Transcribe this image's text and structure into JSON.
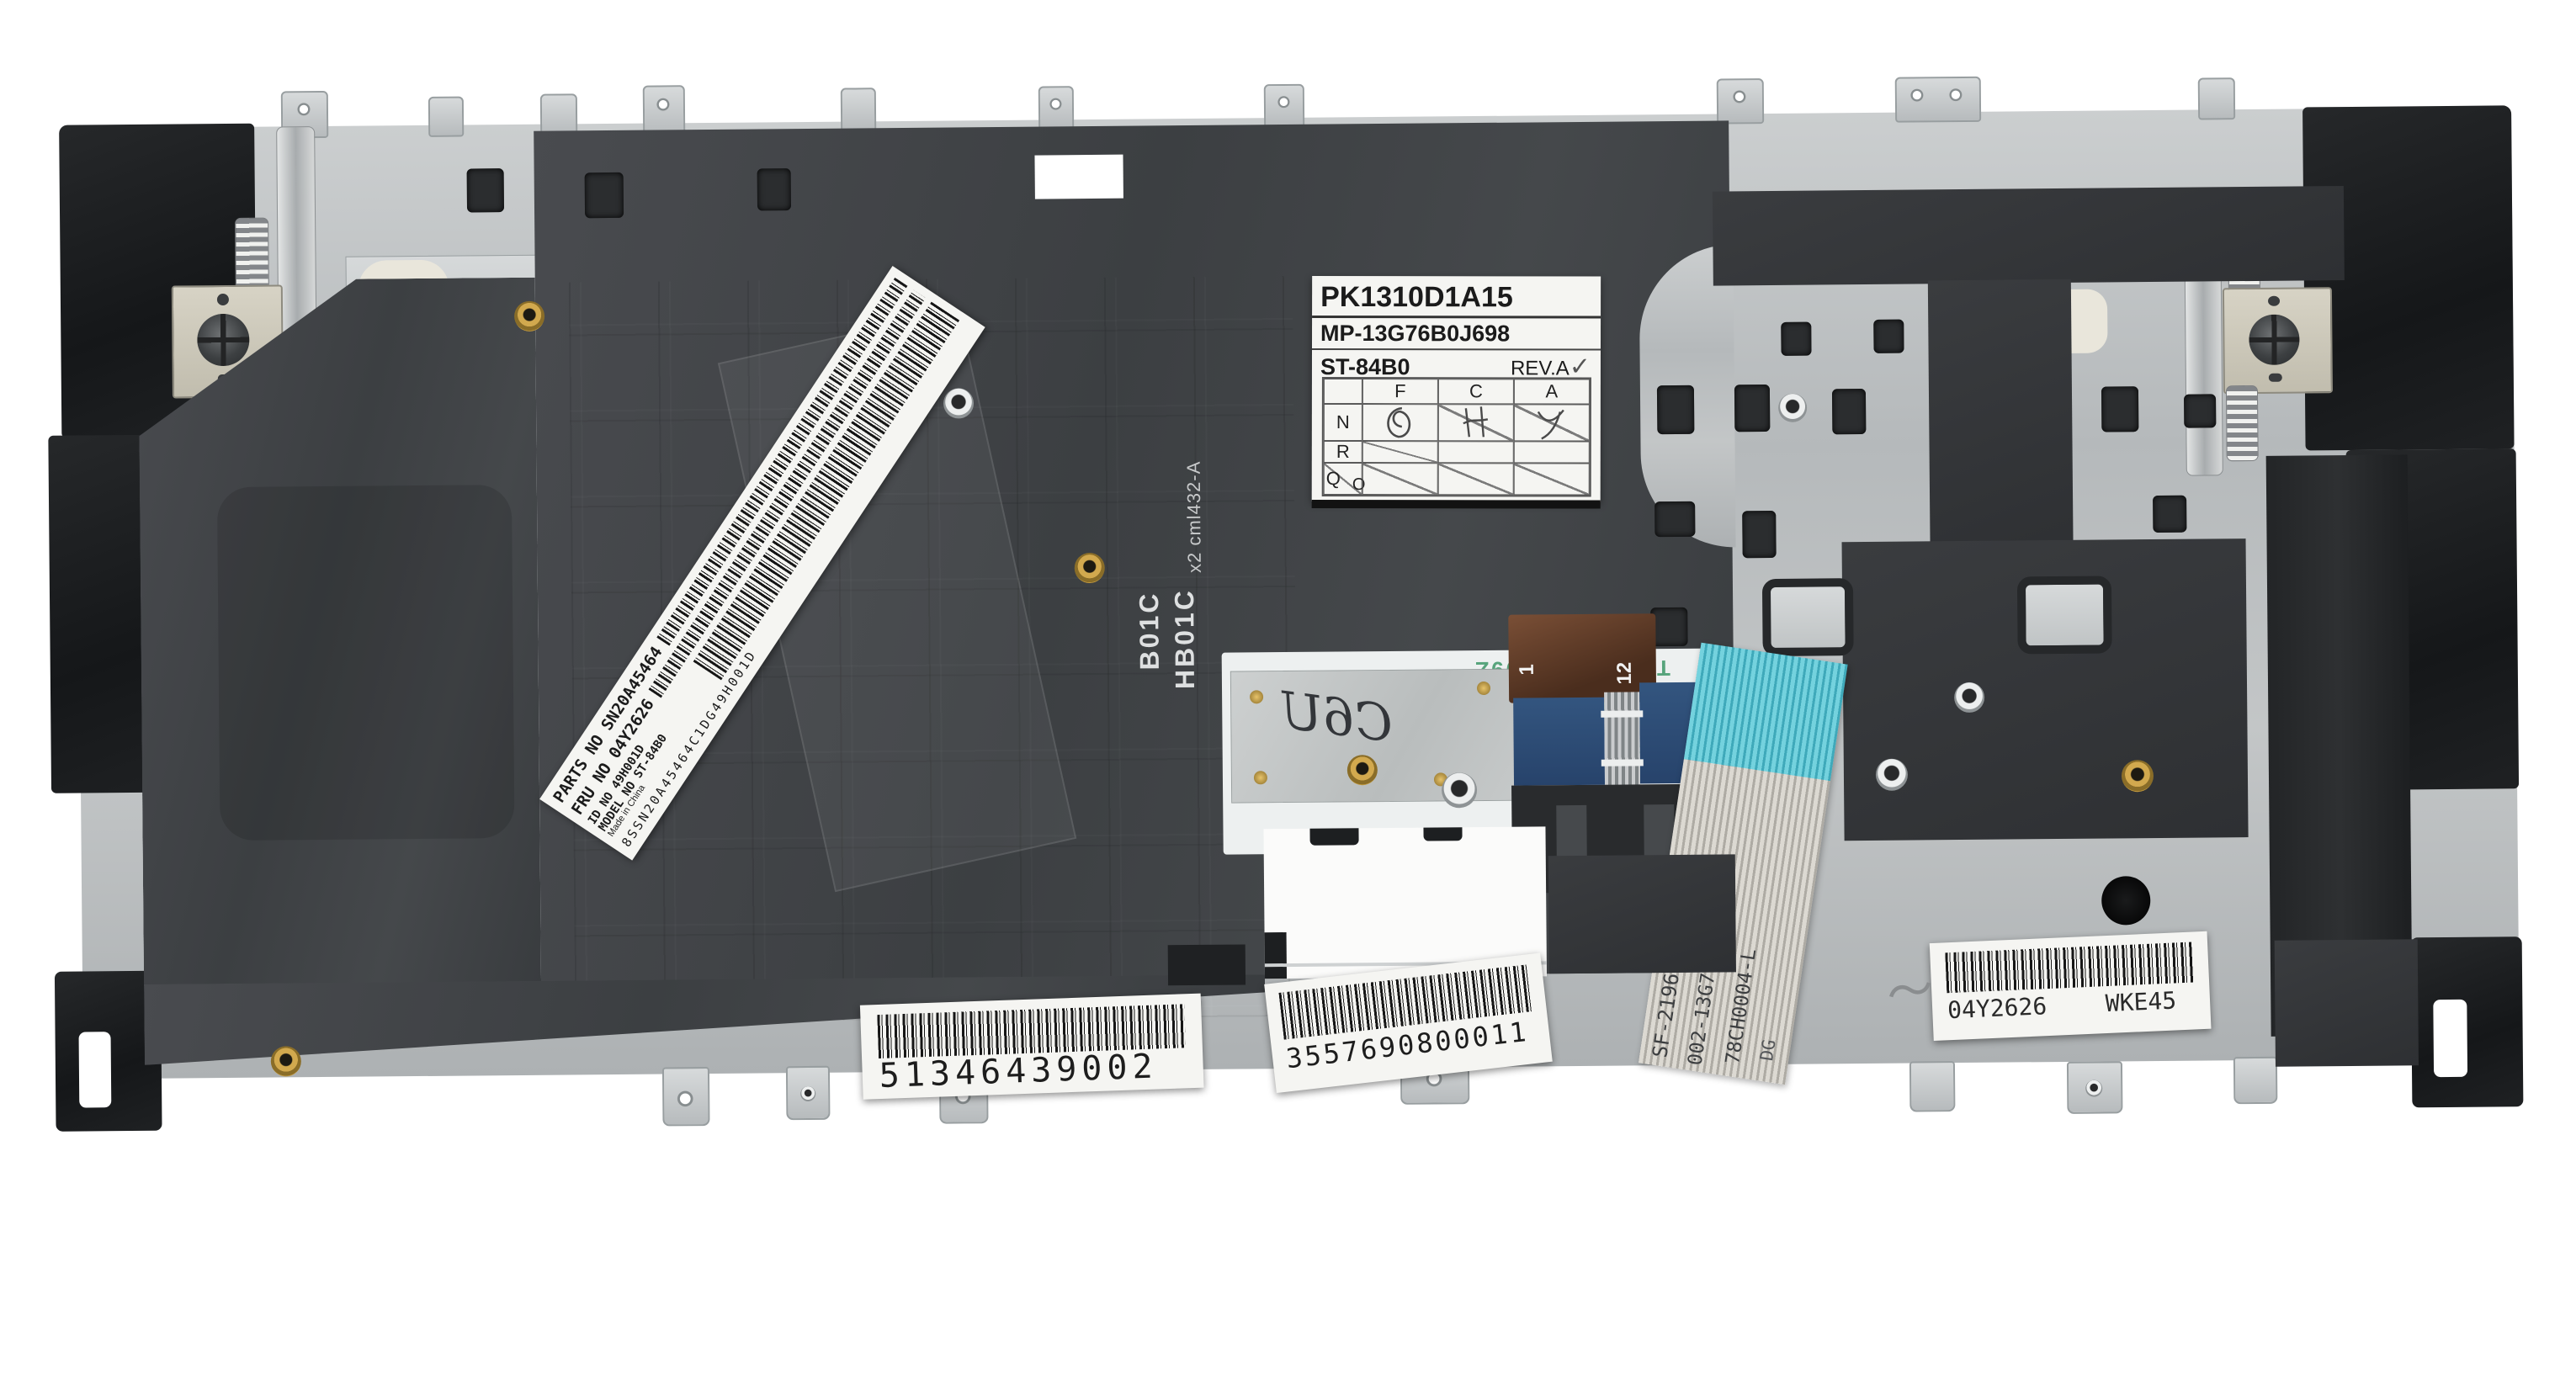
{
  "part_photo": {
    "main_label": {
      "l1": "PK1310D1A15",
      "l2": "MP-13G76B0J698",
      "l3": "ST-84B0",
      "rev": "REV.A",
      "check": "✓",
      "col_f": "F",
      "col_c": "C",
      "col_a": "A",
      "row_n": "N",
      "row_r": "R",
      "row_q": "Q",
      "row_o": "O"
    },
    "serial_label": {
      "l1": "PARTS NO SN20A45464",
      "l2": "FRU NO 04Y2626",
      "l3": "8SSN20A45464C1DG49H001D",
      "l4": "ID NO 49H001D",
      "l5": "MODEL NO ST-84B0",
      "l6": "Made in China"
    },
    "barcode_left": {
      "digits": "51346439002"
    },
    "barcode_center": {
      "digits": "3557690800011"
    },
    "barcode_right": {
      "fru": "04Y2626",
      "code": "WKE45",
      "scribble": "〜"
    },
    "flex": {
      "tatsu": "TATSU E30809Z",
      "hand": "C6U",
      "pin1": "1",
      "pin12": "12",
      "ffc1": "SF-2196",
      "ffc2": "002-13G76LHC01",
      "ffc3": "78CH0004-L",
      "ffc4": "DG"
    },
    "film": {
      "v1": "B01C",
      "v2": "HB01C",
      "v3": "x2 cml432-A"
    },
    "colors": {
      "metal": "#bcc0c1",
      "mylar": "#3f4245",
      "plastic": "#1c1e20",
      "brass": "#bd9440",
      "teal": "#5fc4d2",
      "blue_pad": "#2e4d78",
      "kapton": "#6a4530",
      "green_print": "#57a47c",
      "label": "#f4f4f1"
    }
  }
}
